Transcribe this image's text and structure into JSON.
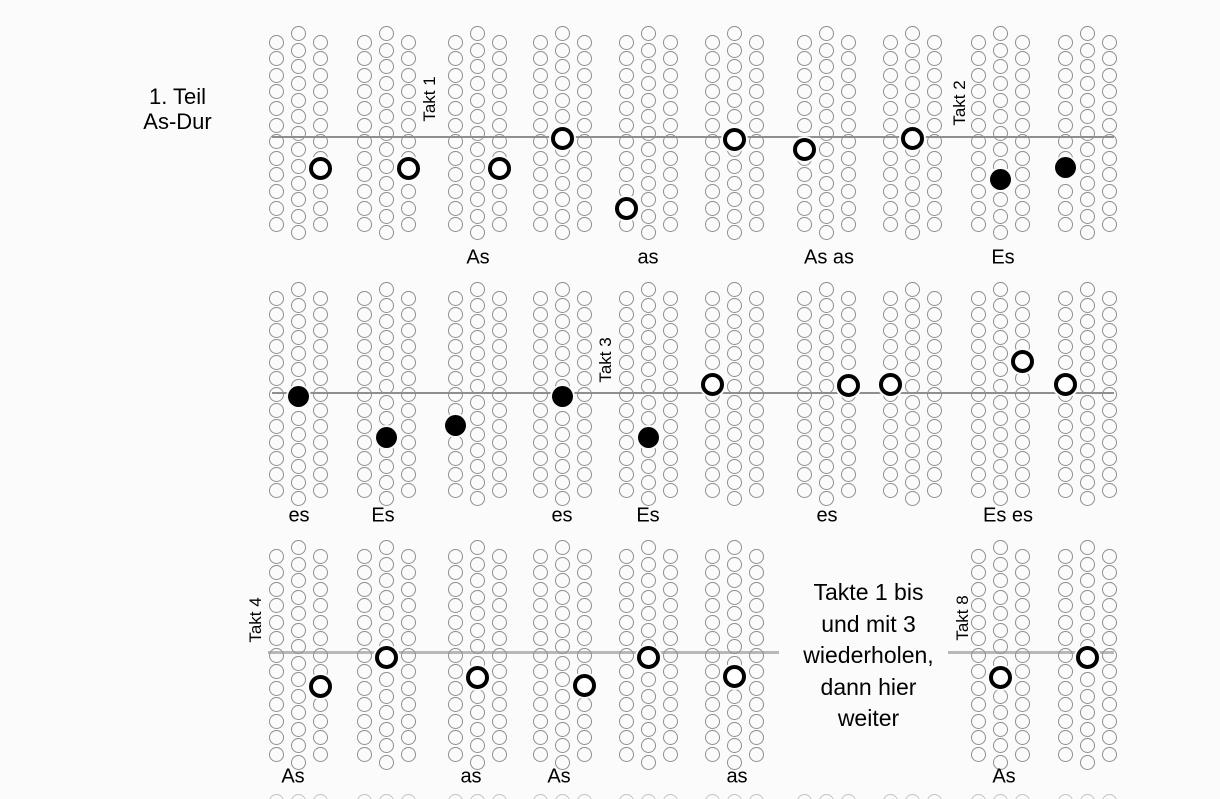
{
  "title": {
    "line1": "1. Teil",
    "line2": "As-Dur"
  },
  "repeat_note": {
    "lines": [
      "Takte 1 bis",
      "und mit 3",
      "wiederholen,",
      "dann hier",
      "weiter"
    ]
  },
  "takt_labels": [
    {
      "text": "Takt 1",
      "x": 430,
      "y": 99
    },
    {
      "text": "Takt 2",
      "x": 960,
      "y": 103
    },
    {
      "text": "Takt 3",
      "x": 606,
      "y": 360
    },
    {
      "text": "Takt 4",
      "x": 256,
      "y": 620
    },
    {
      "text": "Takt 8",
      "x": 963,
      "y": 618
    }
  ],
  "colors": {
    "background": "#fbfbfb",
    "circle_stroke": "#8e8e8e",
    "marker": "#000000",
    "line_thin": "#8f8f8f",
    "line_thick": "#b8b8b8",
    "stub_stroke": "#b2b2b2"
  },
  "grid": {
    "cluster_centers_x": [
      298,
      386,
      477,
      562,
      648,
      734,
      826,
      912,
      1000,
      1087
    ],
    "col_offset": 22,
    "circle_diameter": 15
  },
  "rows": [
    {
      "name": "row-1",
      "line_y": 137,
      "line_thickness": 2,
      "line_color": "#8f8f8f",
      "line_segments": [
        [
          272,
          1114
        ]
      ],
      "side_top": 42,
      "mid_top": 33.7,
      "spacing": 16.6,
      "side_count": 12,
      "mid_count": 13,
      "clusters": [
        1,
        2,
        3,
        4,
        5,
        6,
        7,
        8,
        9,
        10
      ],
      "markers": [
        {
          "pos": 1,
          "col": 1,
          "y": 168,
          "type": "open"
        },
        {
          "pos": 2,
          "col": 1,
          "y": 168,
          "type": "open"
        },
        {
          "pos": 3,
          "col": 1,
          "y": 168,
          "type": "open"
        },
        {
          "pos": 4,
          "col": 0,
          "y": 138,
          "type": "open"
        },
        {
          "pos": 5,
          "col": -1,
          "y": 208,
          "type": "open"
        },
        {
          "pos": 6,
          "col": 0,
          "y": 139,
          "type": "open"
        },
        {
          "pos": 7,
          "col": -1,
          "y": 149,
          "type": "open"
        },
        {
          "pos": 8,
          "col": 0,
          "y": 138,
          "type": "open"
        },
        {
          "pos": 9,
          "col": 0,
          "y": 179,
          "type": "filled"
        },
        {
          "pos": 10,
          "col": -1,
          "y": 167,
          "type": "filled"
        }
      ],
      "note_labels": [
        {
          "text": "As",
          "x": 478,
          "y": 258
        },
        {
          "text": "as",
          "x": 648,
          "y": 258
        },
        {
          "text": "As as",
          "x": 829,
          "y": 258
        },
        {
          "text": "Es",
          "x": 1003,
          "y": 258
        }
      ]
    },
    {
      "name": "row-2",
      "line_y": 393,
      "line_thickness": 2,
      "line_color": "#8f8f8f",
      "line_segments": [
        [
          272,
          1114
        ]
      ],
      "side_top": 298,
      "mid_top": 289.7,
      "spacing": 16.05,
      "side_count": 13,
      "mid_count": 14,
      "clusters": [
        1,
        2,
        3,
        4,
        5,
        6,
        7,
        8,
        9,
        10
      ],
      "markers": [
        {
          "pos": 1,
          "col": 0,
          "y": 396,
          "type": "filled"
        },
        {
          "pos": 2,
          "col": 0,
          "y": 437,
          "type": "filled"
        },
        {
          "pos": 3,
          "col": -1,
          "y": 425,
          "type": "filled"
        },
        {
          "pos": 4,
          "col": 0,
          "y": 396,
          "type": "filled"
        },
        {
          "pos": 5,
          "col": 0,
          "y": 437,
          "type": "filled"
        },
        {
          "pos": 6,
          "col": -1,
          "y": 384,
          "type": "open"
        },
        {
          "pos": 7,
          "col": 1,
          "y": 385,
          "type": "open"
        },
        {
          "pos": 8,
          "col": -1,
          "y": 384,
          "type": "open"
        },
        {
          "pos": 9,
          "col": 1,
          "y": 361,
          "type": "open"
        },
        {
          "pos": 10,
          "col": -1,
          "y": 384,
          "type": "open"
        }
      ],
      "note_labels": [
        {
          "text": "es",
          "x": 299,
          "y": 516
        },
        {
          "text": "Es",
          "x": 383,
          "y": 516
        },
        {
          "text": "es",
          "x": 562,
          "y": 516
        },
        {
          "text": "Es",
          "x": 648,
          "y": 516
        },
        {
          "text": "es",
          "x": 827,
          "y": 516
        },
        {
          "text": "Es es",
          "x": 1008,
          "y": 516
        }
      ]
    },
    {
      "name": "row-3",
      "line_y": 652,
      "line_thickness": 3,
      "line_color": "#b8b8b8",
      "line_segments": [
        [
          268,
          779
        ],
        [
          948,
          1114
        ]
      ],
      "side_top": 556,
      "mid_top": 547.8,
      "spacing": 16.5,
      "side_count": 13,
      "mid_count": 14,
      "clusters": [
        1,
        2,
        3,
        4,
        5,
        6,
        9,
        10
      ],
      "markers": [
        {
          "pos": 1,
          "col": 1,
          "y": 686,
          "type": "open"
        },
        {
          "pos": 2,
          "col": 0,
          "y": 657,
          "type": "open"
        },
        {
          "pos": 3,
          "col": 0,
          "y": 677,
          "type": "open"
        },
        {
          "pos": 4,
          "col": 1,
          "y": 685,
          "type": "open"
        },
        {
          "pos": 5,
          "col": 0,
          "y": 657,
          "type": "open"
        },
        {
          "pos": 6,
          "col": 0,
          "y": 676,
          "type": "open"
        },
        {
          "pos": 9,
          "col": 0,
          "y": 677,
          "type": "open"
        },
        {
          "pos": 10,
          "col": 0,
          "y": 657,
          "type": "open"
        }
      ],
      "note_labels": [
        {
          "text": "As",
          "x": 293,
          "y": 777
        },
        {
          "text": "as",
          "x": 471,
          "y": 777
        },
        {
          "text": "As",
          "x": 559,
          "y": 777
        },
        {
          "text": "as",
          "x": 737,
          "y": 777
        },
        {
          "text": "As",
          "x": 1004,
          "y": 777
        }
      ]
    }
  ],
  "bottom_stub_row": {
    "y": 801,
    "positions": [
      1,
      2,
      3,
      4,
      5,
      6,
      7,
      8,
      9,
      10
    ]
  }
}
